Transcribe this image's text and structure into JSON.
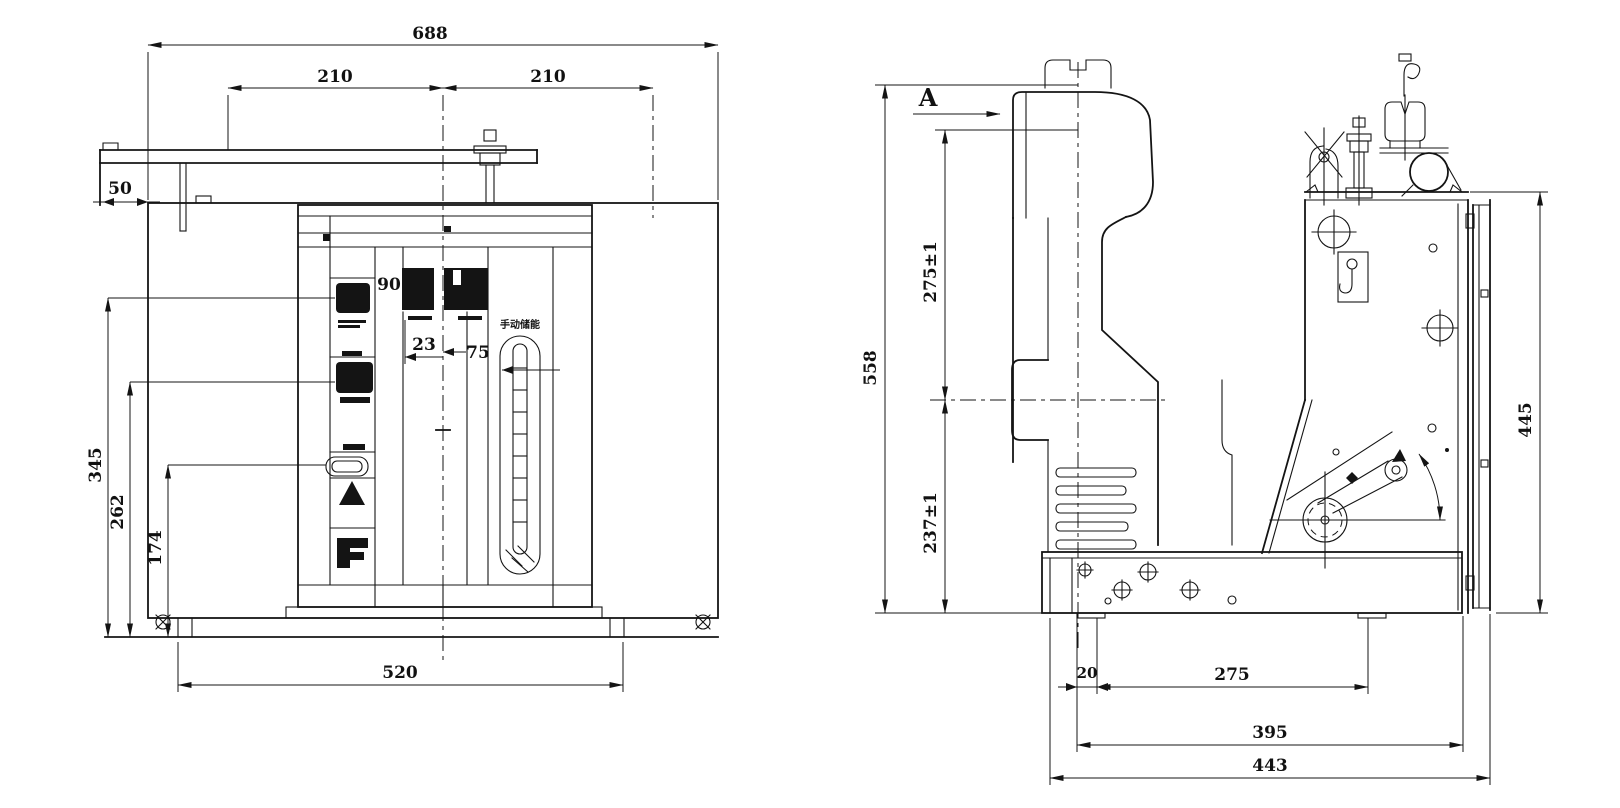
{
  "meta": {
    "type": "engineering-drawing",
    "views": "front and side elevation of vacuum circuit breaker",
    "background": "#ffffff",
    "line_color": "#141414"
  },
  "front": {
    "dim_total": "688",
    "dim_span_left": "210",
    "dim_span_right": "210",
    "dim_bracket_offset": "50",
    "dim_display_width": "90",
    "dim_offset_small": "23",
    "dim_offset_slot": "75",
    "dim_height_outer": "345",
    "dim_height_mid": "262",
    "dim_height_inner": "174",
    "dim_base_width": "520",
    "slot_label": "手动储能"
  },
  "side": {
    "section_label": "A",
    "dim_total_height": "558",
    "dim_upper": "275±1",
    "dim_lower": "237±1",
    "dim_panel_height": "445",
    "dim_edge": "20",
    "dim_holes": "275",
    "dim_feet": "395",
    "dim_base": "443"
  }
}
